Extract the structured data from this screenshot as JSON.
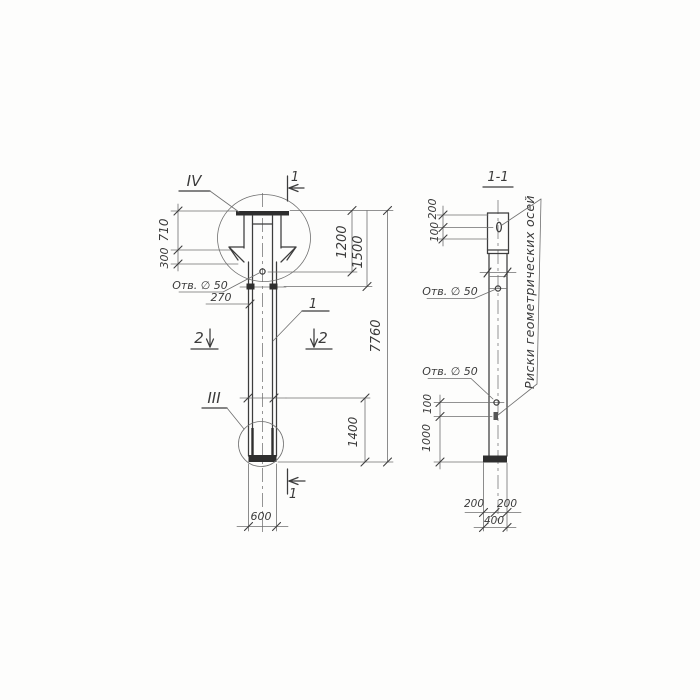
{
  "drawing": {
    "section_title": "1-1",
    "callouts": {
      "detail_top": "IV",
      "detail_bottom": "III",
      "part": "1",
      "section_cut_1": "1",
      "section_cut_2": "2",
      "hole_label": "Отв. ∅ 50",
      "axes_note": "Риски геометрических осей"
    },
    "front_dims": {
      "plate_710": "710",
      "flare_300": "300",
      "shaft_270": "270",
      "top_1200": "1200",
      "top_1500": "1500",
      "total_7760": "7760",
      "bottom_1400": "1400",
      "width_600": "600"
    },
    "section_dims": {
      "top_200": "200",
      "top_100": "100",
      "bottom_100": "100",
      "bottom_1000": "1000",
      "base_left_200": "200",
      "base_right_200": "200",
      "base_400": "400"
    }
  }
}
